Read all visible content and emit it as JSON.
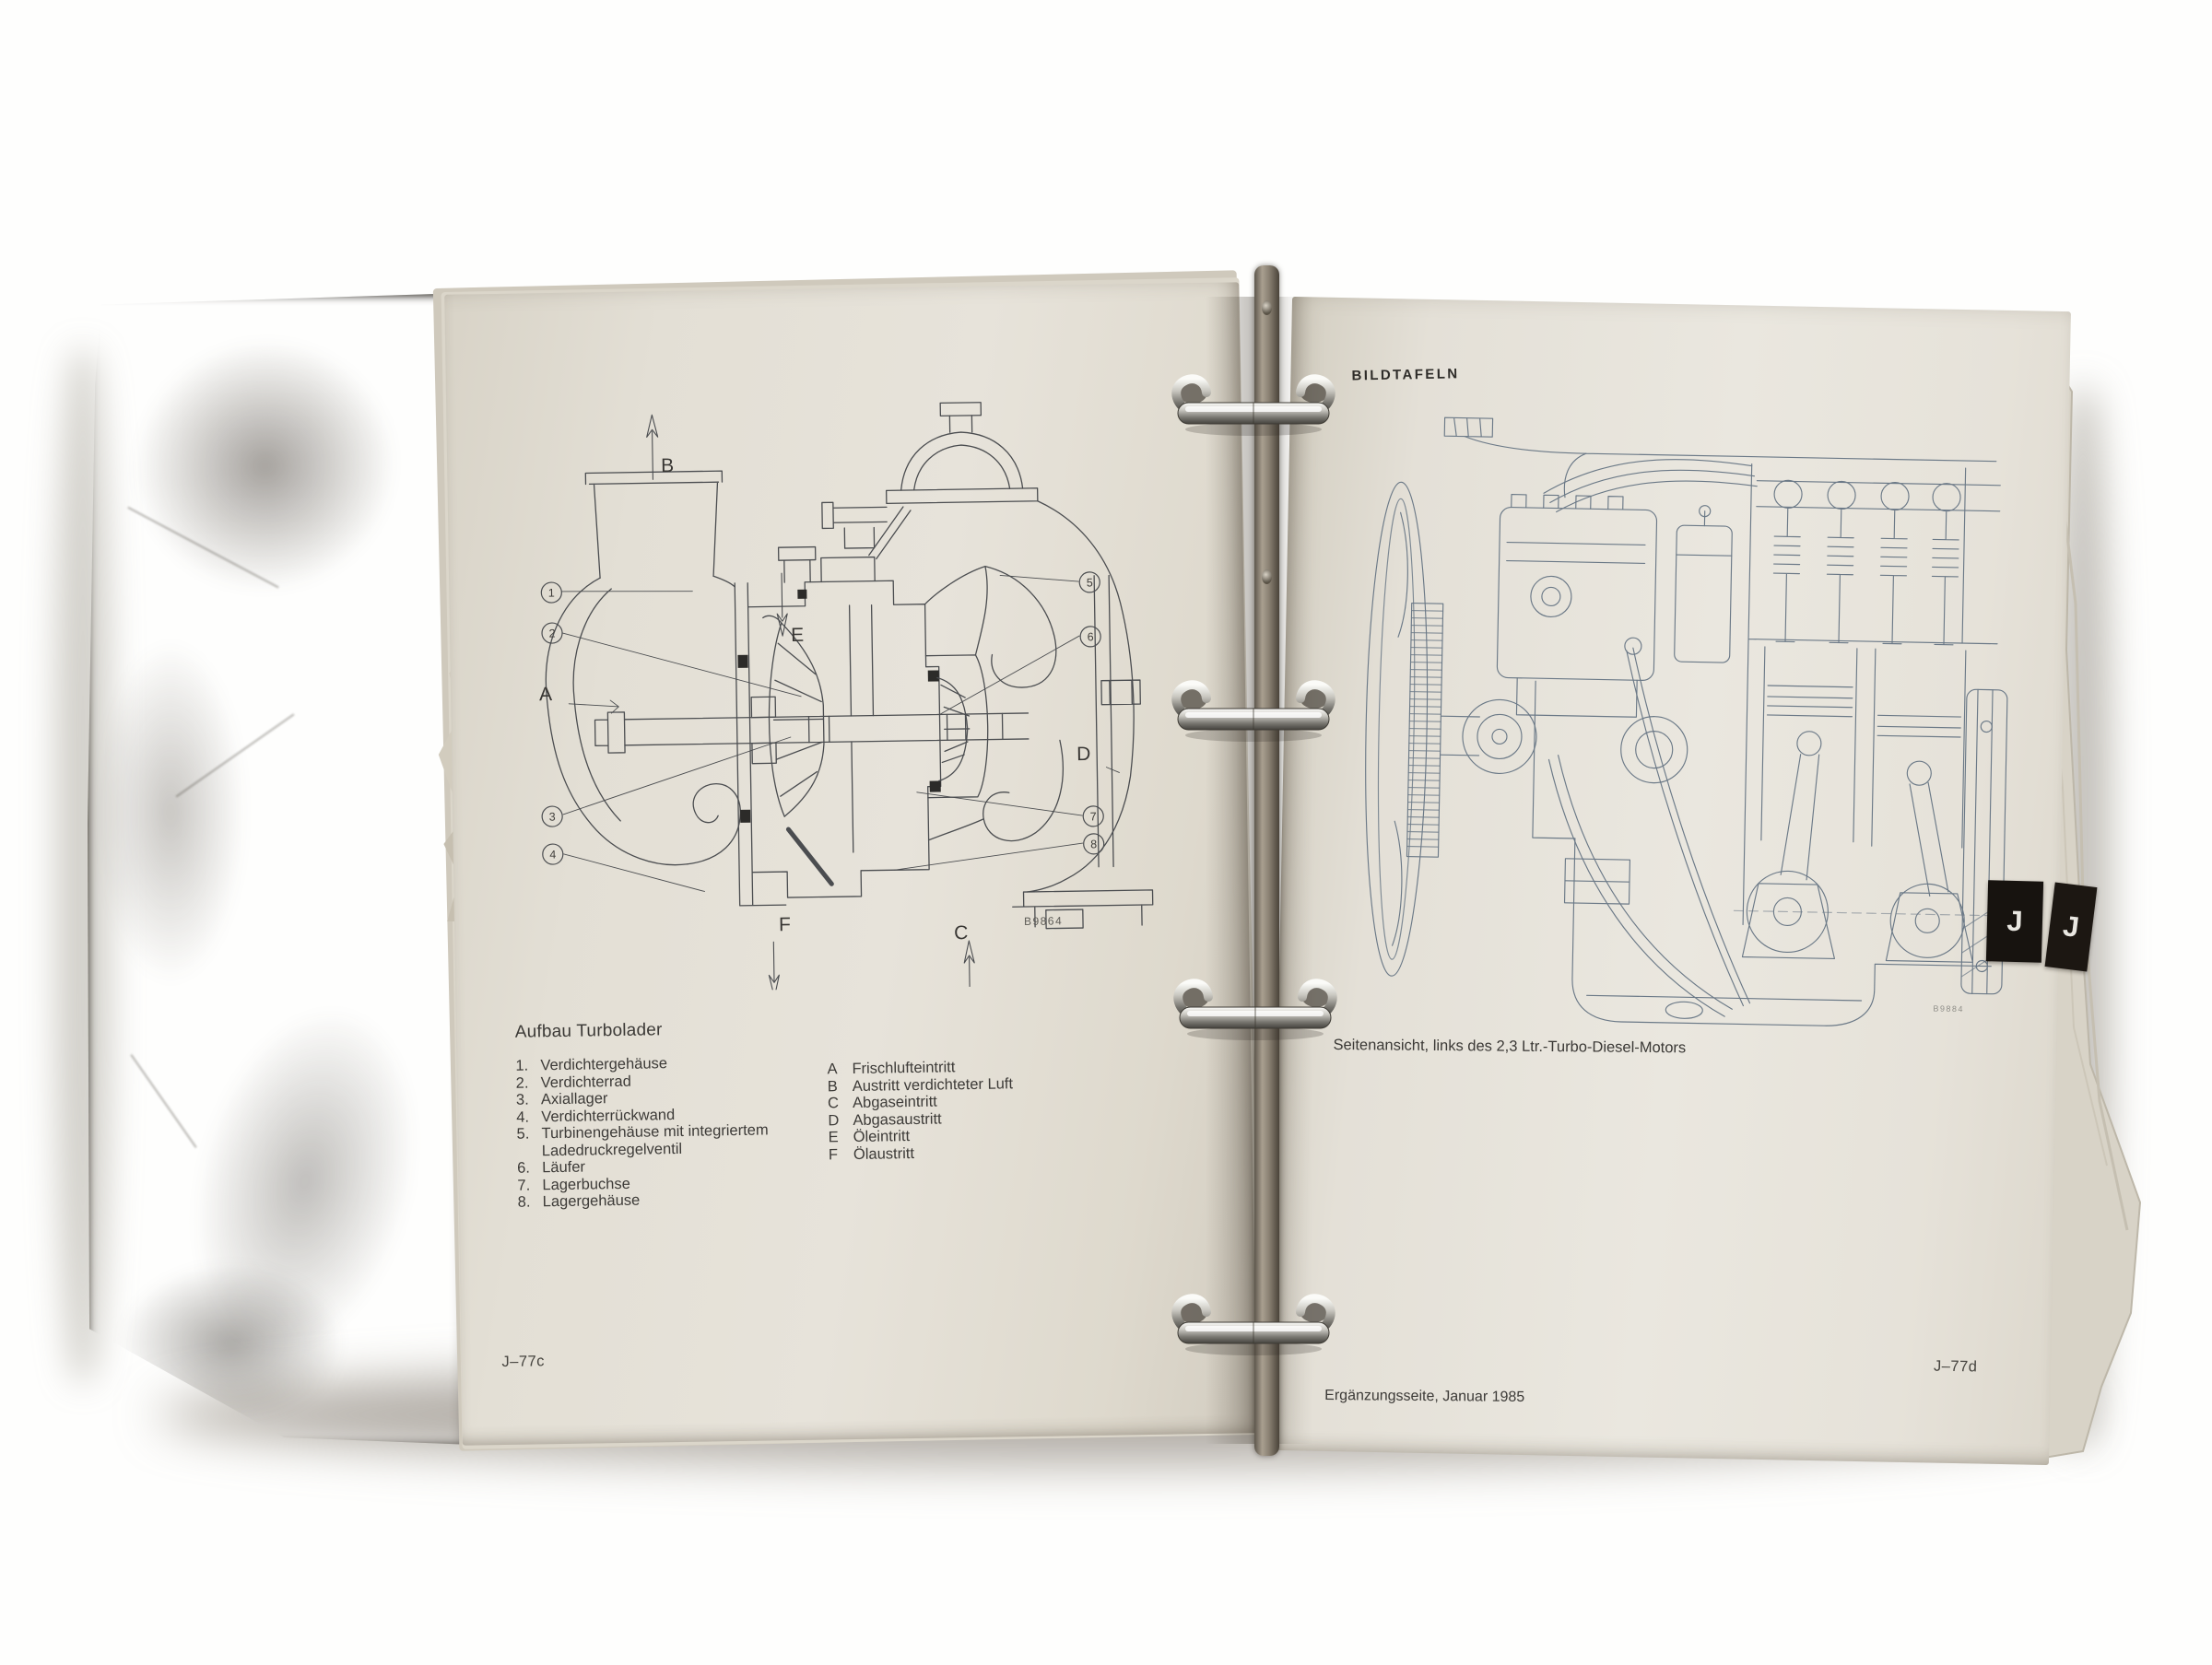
{
  "left_page": {
    "title": "Aufbau Turbolader",
    "numbered_legend": [
      {
        "num": "1.",
        "text": "Verdichtergehäuse"
      },
      {
        "num": "2.",
        "text": "Verdichterrad"
      },
      {
        "num": "3.",
        "text": "Axiallager"
      },
      {
        "num": "4.",
        "text": "Verdichterrückwand"
      },
      {
        "num": "5.",
        "text": "Turbinengehäuse mit integriertem"
      },
      {
        "num": "",
        "text": "Ladedruckregelventil"
      },
      {
        "num": "6.",
        "text": "Läufer"
      },
      {
        "num": "7.",
        "text": "Lagerbuchse"
      },
      {
        "num": "8.",
        "text": "Lagergehäuse"
      }
    ],
    "letter_legend": [
      {
        "key": "A",
        "text": "Frischlufteintritt"
      },
      {
        "key": "B",
        "text": "Austritt verdichteter Luft"
      },
      {
        "key": "C",
        "text": "Abgaseintritt"
      },
      {
        "key": "D",
        "text": "Abgasaustritt"
      },
      {
        "key": "E",
        "text": "Öleintritt"
      },
      {
        "key": "F",
        "text": "Ölaustritt"
      }
    ],
    "page_number": "J–77c",
    "diagram_code": "B9864",
    "diagram_labels": {
      "A": "A",
      "B": "B",
      "C": "C",
      "D": "D",
      "E": "E",
      "F": "F",
      "n1": "1",
      "n2": "2",
      "n3": "3",
      "n4": "4",
      "n5": "5",
      "n6": "6",
      "n7": "7",
      "n8": "8"
    }
  },
  "right_page": {
    "header": "BILDTAFELN",
    "caption": "Seitenansicht, links des 2,3 Ltr.-Turbo-Diesel-Motors",
    "footer_left": "Ergänzungsseite, Januar 1985",
    "page_number": "J–77d",
    "diagram_code": "B9884",
    "tab_label": "J",
    "tab_label_back": "J"
  },
  "colors": {
    "paper": "#e7e3da",
    "binder_cover": "#7b7368",
    "tab_black": "#17130f",
    "turbo_line": "#4b4d50",
    "engine_line": "#6b7987"
  }
}
